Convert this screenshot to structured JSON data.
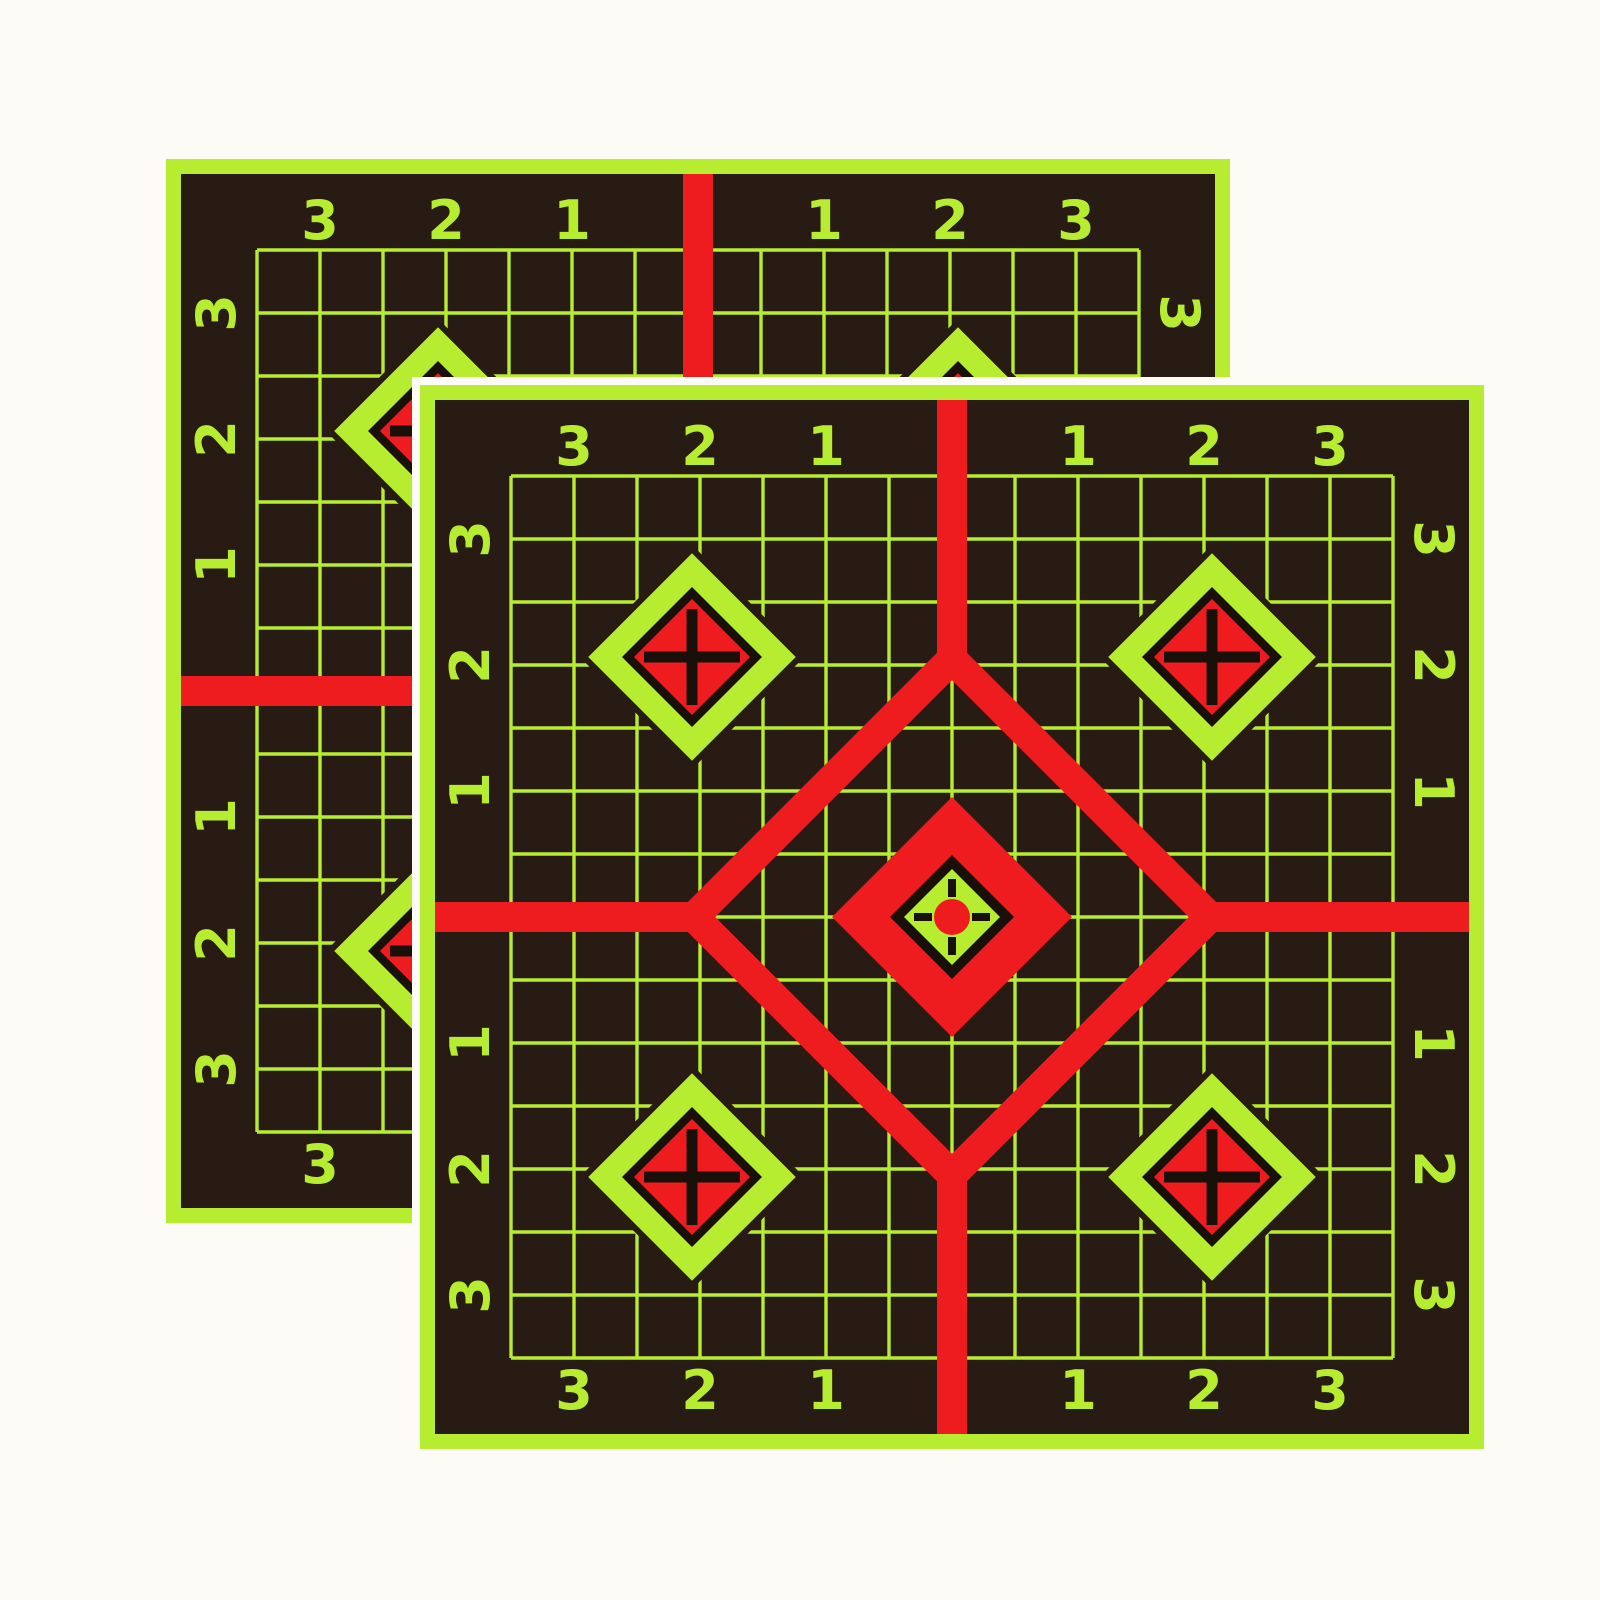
{
  "page": {
    "background_color": "#fcfbf5",
    "description": "Two overlapping adhesive splatter shooting-target sheets on a white background"
  },
  "colors": {
    "fluorescent_green": "#b7ed30",
    "red": "#ee1c1e",
    "dark_background": "#281b13",
    "ink_black": "#1a100a",
    "halo_white": "#fcfbf5"
  },
  "target_design": {
    "grid_cells": 14,
    "scale_labels": {
      "top": [
        "3",
        "2",
        "1",
        "1",
        "2",
        "3"
      ],
      "bottom": [
        "3",
        "2",
        "1",
        "1",
        "2",
        "3"
      ],
      "left": [
        "3",
        "2",
        "1",
        "1",
        "2",
        "3"
      ],
      "right": [
        "3",
        "2",
        "1",
        "1",
        "2",
        "3"
      ]
    },
    "corner_marker": "plus-cross-diamond",
    "center_marker": "diamond-bullseye-with-crosshair-dot"
  },
  "sheets": [
    {
      "id": "back",
      "x": 166,
      "y": 159,
      "size": 1064,
      "halo": false
    },
    {
      "id": "front",
      "x": 420,
      "y": 385,
      "size": 1064,
      "halo": true
    }
  ]
}
